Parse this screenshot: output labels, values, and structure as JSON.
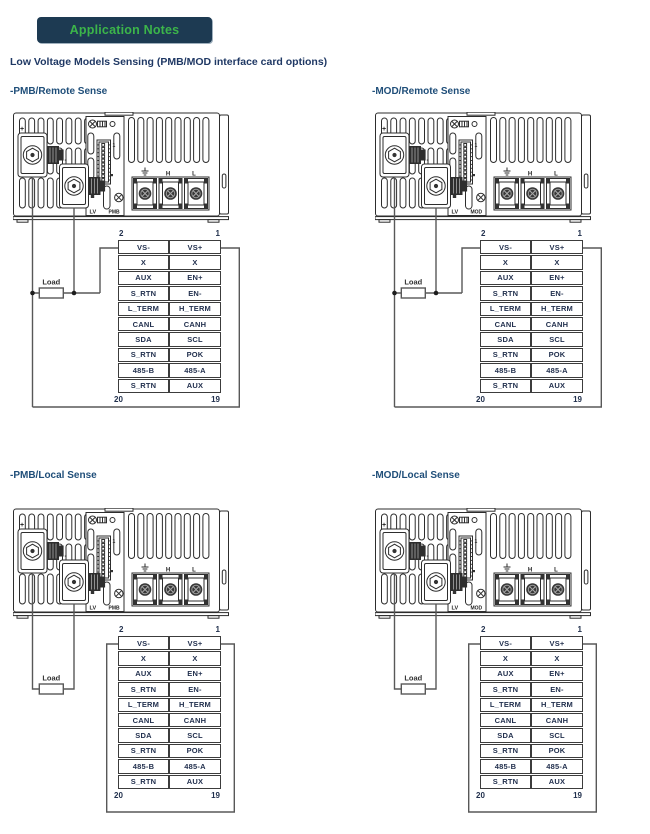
{
  "header": {
    "badge": "Application Notes"
  },
  "subtitle": "Low Voltage Models Sensing (PMB/MOD interface card options)",
  "load_label": "Load",
  "pin_table": {
    "top_left_pin": "2",
    "top_right_pin": "1",
    "bottom_left_pin": "20",
    "bottom_right_pin": "19",
    "rows": [
      [
        "VS-",
        "VS+"
      ],
      [
        "X",
        "X"
      ],
      [
        "AUX",
        "EN+"
      ],
      [
        "S_RTN",
        "EN-"
      ],
      [
        "L_TERM",
        "H_TERM"
      ],
      [
        "CANL",
        "CANH"
      ],
      [
        "SDA",
        "SCL"
      ],
      [
        "S_RTN",
        "POK"
      ],
      [
        "485-B",
        "485-A"
      ],
      [
        "S_RTN",
        "AUX"
      ]
    ]
  },
  "psu": {
    "plus_label": "+",
    "minus_label": "-",
    "pin1_label": "1",
    "lv_label": "LV",
    "h_label": "H",
    "l_label": "L"
  },
  "icons": {
    "ground": "ground-icon",
    "screw": "screw-icon"
  },
  "colors": {
    "badge_bg": "#1d3a52",
    "badge_text": "#3cb54a",
    "heading_text": "#1f3864",
    "section_title": "#1f4e79",
    "wire": "#585858",
    "table_border": "#3c3c3c"
  },
  "diagrams": [
    {
      "id": "pmb-remote",
      "title": "-PMB/Remote Sense",
      "card_label": "PMB",
      "sense": "remote"
    },
    {
      "id": "mod-remote",
      "title": "-MOD/Remote Sense",
      "card_label": "MOD",
      "sense": "remote"
    },
    {
      "id": "pmb-local",
      "title": "-PMB/Local Sense",
      "card_label": "PMB",
      "sense": "local"
    },
    {
      "id": "mod-local",
      "title": "-MOD/Local Sense",
      "card_label": "MOD",
      "sense": "local"
    }
  ]
}
